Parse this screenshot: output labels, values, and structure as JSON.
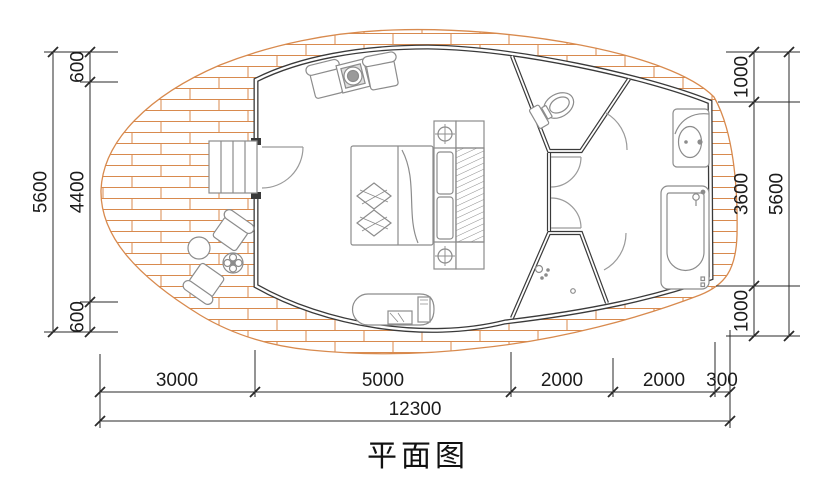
{
  "title": "平面图",
  "colors": {
    "wall": "#3a3a3a",
    "furniture_line": "#8c8c8c",
    "door_arc": "#9a9a9a",
    "deck_brick": "#d88a4e",
    "dimension_line": "#2a2a2a",
    "text": "#1c1c1c",
    "background": "#ffffff"
  },
  "dimensions": {
    "left": {
      "overall": "5600",
      "segments": [
        "600",
        "4400",
        "600"
      ]
    },
    "right": {
      "overall": "5600",
      "segments": [
        "1000",
        "3600",
        "1000"
      ]
    },
    "bottom": {
      "overall": "12300",
      "segments": [
        "3000",
        "5000",
        "2000",
        "2000",
        "300"
      ]
    }
  },
  "symbols": [
    "wood-deck",
    "entry-stairs",
    "entry-door",
    "lounge-chair",
    "plant-table",
    "double-bed",
    "pillow",
    "nightstand-lamp",
    "wardrobe",
    "tv-console",
    "outdoor-armchair",
    "round-side-table",
    "flower-table",
    "toilet",
    "washbasin",
    "bathtub",
    "shower-head",
    "floor-drain",
    "door-swing"
  ]
}
